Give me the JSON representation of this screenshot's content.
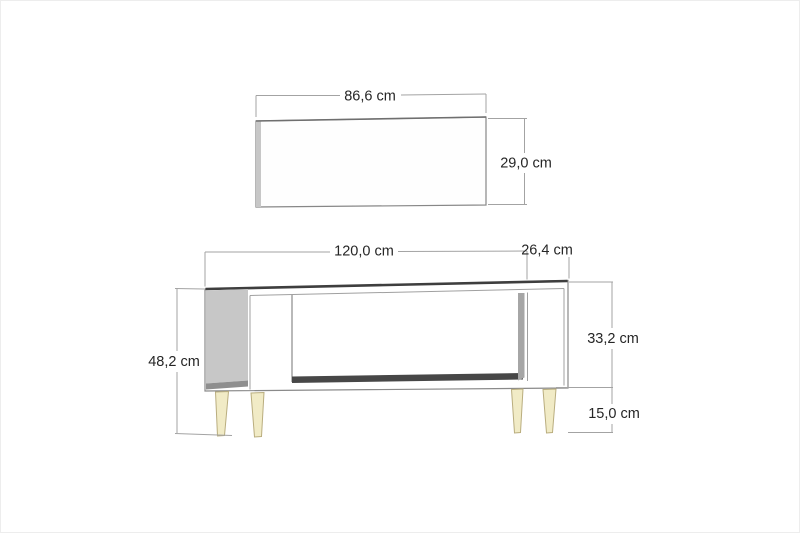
{
  "page": {
    "background": "#ffffff",
    "border": "#ededed"
  },
  "diagram": {
    "type": "furniture-dimension-drawing",
    "unit": "cm",
    "wall_panel": {
      "width_label": "86,6 cm",
      "height_label": "29,0 cm"
    },
    "tv_stand": {
      "width_label": "120,0 cm",
      "depth_label": "26,4 cm",
      "height_with_legs_label": "48,2 cm",
      "body_height_label": "33,2 cm",
      "leg_height_label": "15,0 cm"
    },
    "colors": {
      "outline": "#8a8a8a",
      "dark_edge": "#3e3e3e",
      "dimension_line": "#a3a3a3",
      "side_panel_gray": "#c7c7c7",
      "side_panel_shadow": "#8e8e8e",
      "interior_strip": "#474747",
      "interior_wall_gray": "#a6a6a6",
      "leg_fill": "#f1ebc6",
      "leg_stroke": "#b9ad7e",
      "label_text": "#262626"
    }
  }
}
